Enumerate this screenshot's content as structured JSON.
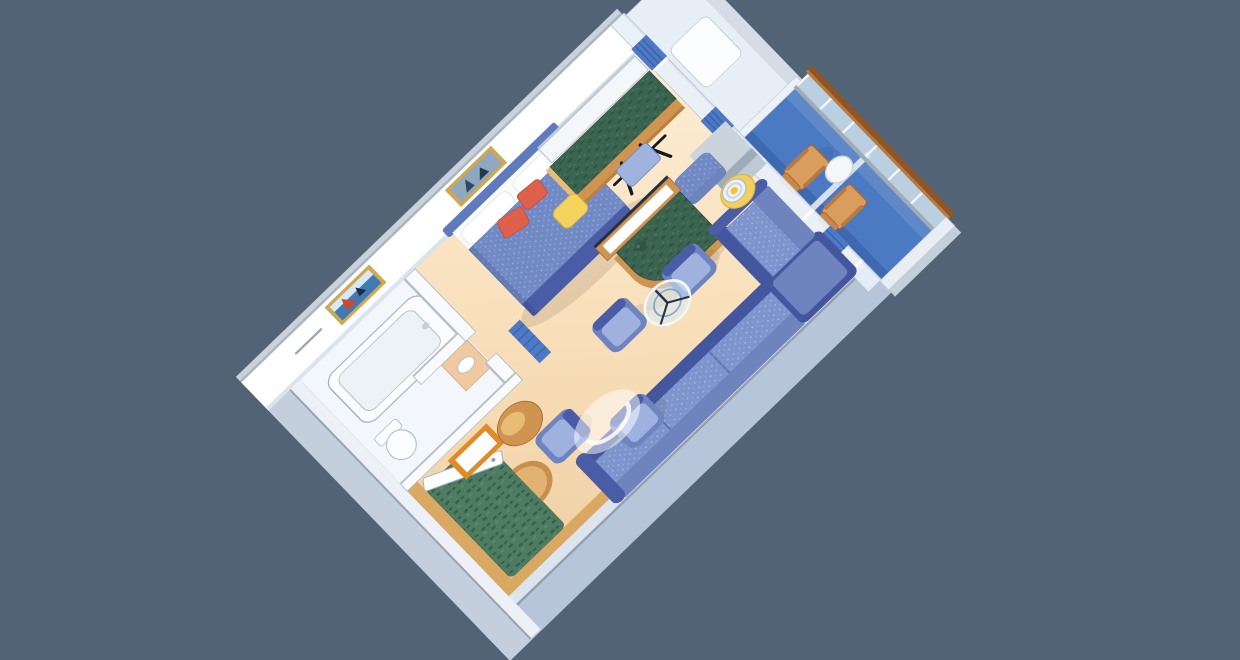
{
  "scene": {
    "title": "Isometric 3D cutaway floor plan of a cruise ship grand suite with private balcony",
    "view": "isometric-cutaway"
  },
  "palette": {
    "background": "#516375",
    "floor": "#F8DFBA",
    "floor_light": "#FDEED6",
    "floor_dark": "#F0D0A4",
    "bathroom_floor": "#F3F7FB",
    "carpet_green": "#4E7C62",
    "carpet_green_dark": "#35604B",
    "balcony_floor": "#4C7AC2",
    "balcony_floor_dark": "#3E69B0",
    "wall_white": "#FFFFFF",
    "wall_cap_gray": "#AAB5C0",
    "wall_outer_blue": "#B6C5D9",
    "wood": "#CE9450",
    "wood_light": "#E8BC76",
    "wood_floor": "#D9A964",
    "sofa_blue": "#7D94CC",
    "sofa_navy": "#44569E",
    "sofa_mid": "#6F84BE",
    "bed_blue": "#7189C4",
    "bed_foot_navy": "#4A5CA6",
    "cushion_coral": "#DE604A",
    "curtain_blue": "#4E79C4",
    "marble_green": "#3A6350",
    "stool_yellow": "#F4D45E",
    "mirror_orange": "#E08A28",
    "frame_gold": "#D1A74F",
    "handrail_brown": "#8F5527",
    "glass_blue": "#D9E8F4"
  },
  "rooms": [
    {
      "name": "bathroom",
      "items": [
        "bathtub",
        "toilet",
        "sink-counter",
        "ship-painting",
        "towel-bar",
        "partition-walls"
      ]
    },
    {
      "name": "bedroom",
      "items": [
        "double-bed",
        "white-pillows",
        "coral-cushions",
        "headboard",
        "sailboat-artwork",
        "vanity-desk",
        "desk-mirror",
        "yellow-stool",
        "black-bench",
        "blue-ottoman"
      ]
    },
    {
      "name": "entry",
      "items": [
        "entry-door",
        "orange-framed-mirror",
        "round-wood-table",
        "pleated-curtain"
      ]
    },
    {
      "name": "living-room",
      "items": [
        "sectional-sofa",
        "armchair-1",
        "armchair-2",
        "armchair-3",
        "armchair-4",
        "glass-coffee-table",
        "glass-side-table",
        "lamp-table",
        "floor-lamp",
        "tv-console",
        "green-carpet",
        "wood-floor-border"
      ]
    },
    {
      "name": "balcony",
      "items": [
        "deck-chair-1",
        "deck-chair-2",
        "round-table",
        "glass-railing",
        "wood-handrail",
        "privacy-partition",
        "sliding-glass-doors",
        "blue-curtains"
      ]
    }
  ]
}
